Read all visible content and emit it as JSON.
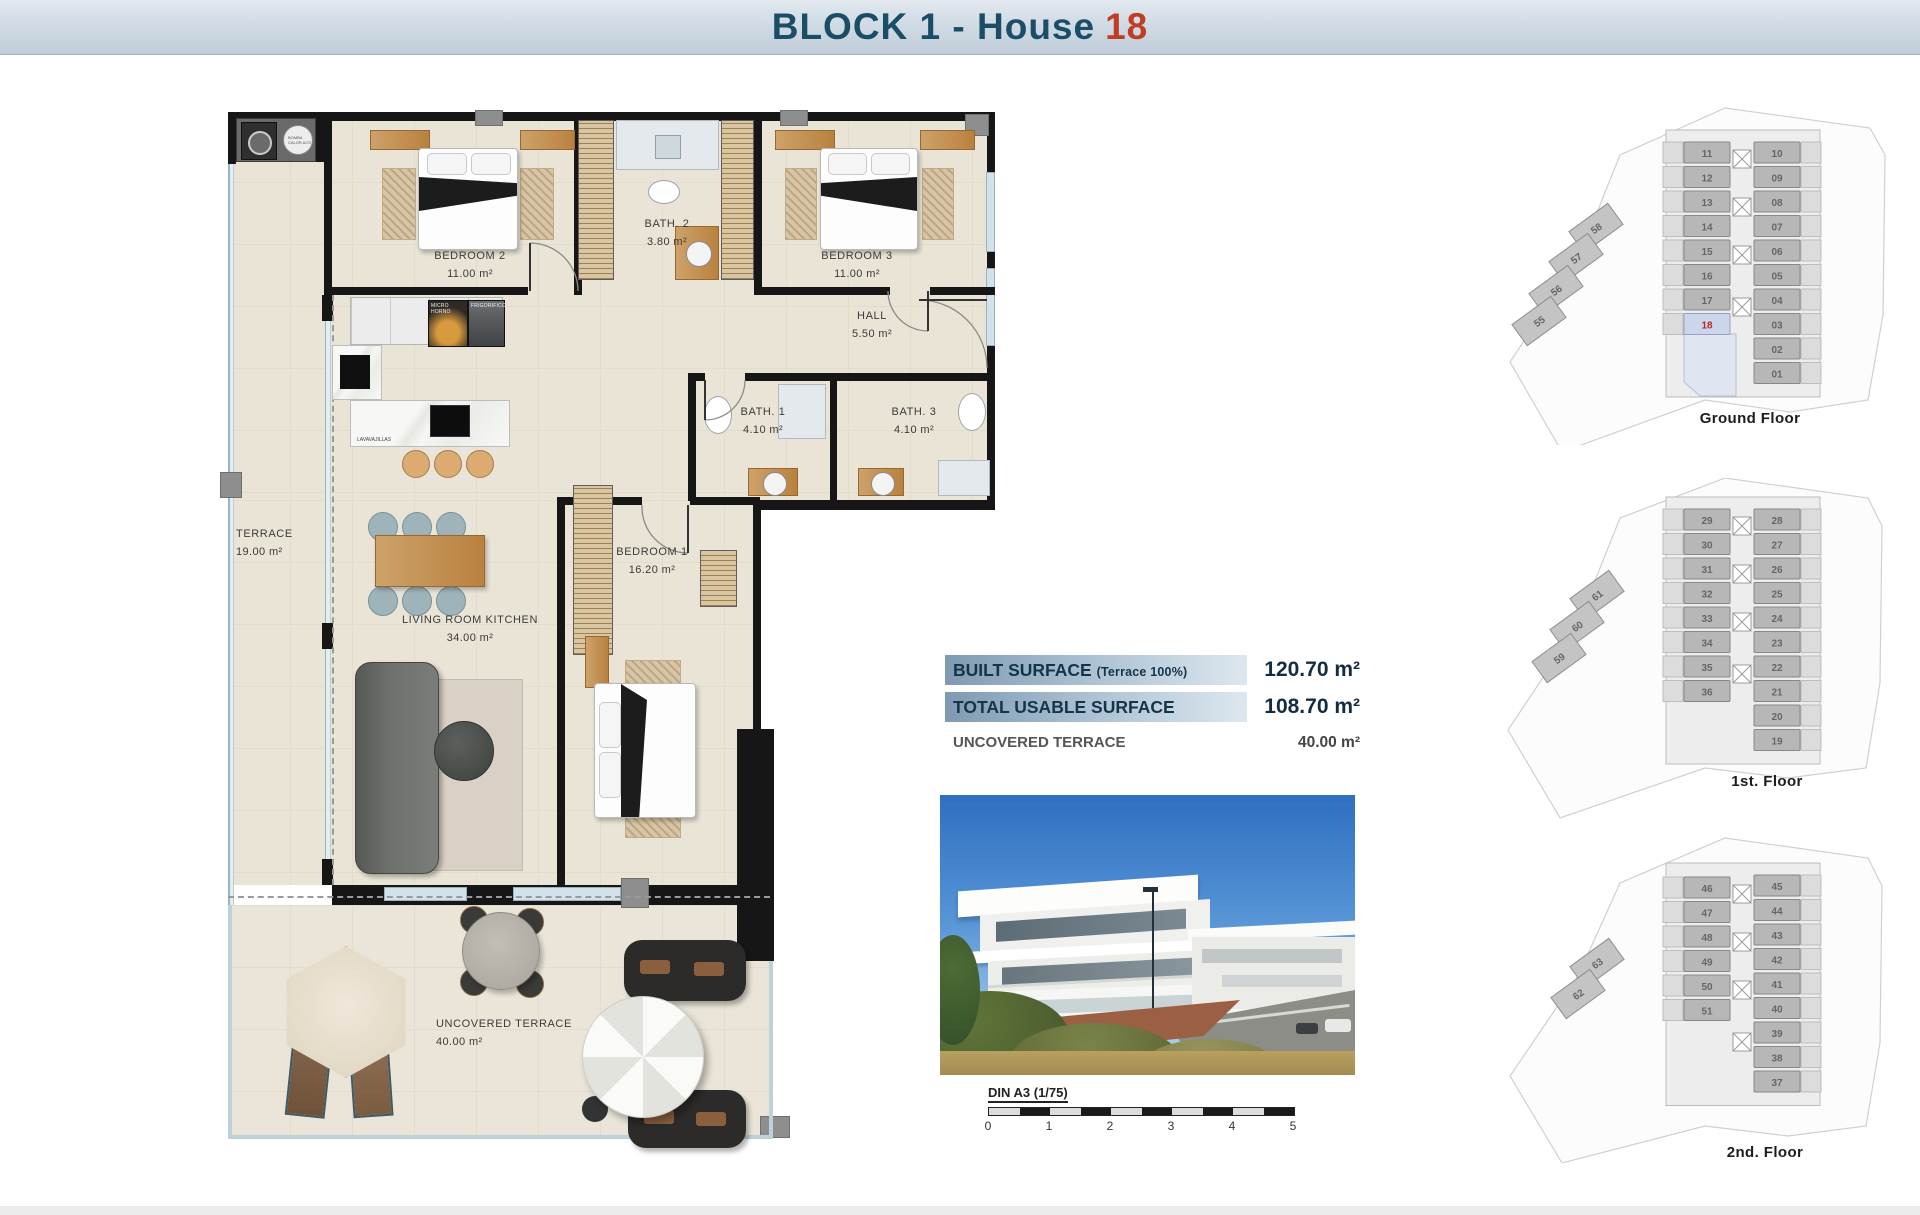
{
  "header": {
    "title": "BLOCK 1 - House",
    "house_number": "18"
  },
  "plan": {
    "rooms": [
      {
        "id": "terrace",
        "name": "TERRACE",
        "area": "19.00 m²"
      },
      {
        "id": "bedroom2",
        "name": "BEDROOM 2",
        "area": "11.00 m²"
      },
      {
        "id": "bath2",
        "name": "BATH. 2",
        "area": "3.80 m²"
      },
      {
        "id": "bedroom3",
        "name": "BEDROOM 3",
        "area": "11.00 m²"
      },
      {
        "id": "hall",
        "name": "HALL",
        "area": "5.50 m²"
      },
      {
        "id": "bath1",
        "name": "BATH. 1",
        "area": "4.10 m²"
      },
      {
        "id": "bath3",
        "name": "BATH. 3",
        "area": "4.10 m²"
      },
      {
        "id": "bedroom1",
        "name": "BEDROOM 1",
        "area": "16.20 m²"
      },
      {
        "id": "living",
        "name": "LIVING ROOM KITCHEN",
        "area": "34.00 m²"
      },
      {
        "id": "uncovered",
        "name": "UNCOVERED TERRACE",
        "area": "40.00 m²"
      }
    ],
    "appliances": {
      "micro": "MICRO HORNO",
      "fridge": "FRIGORIFICO",
      "dishwasher": "LAVAVAJILLAS",
      "washer": "LAVADORA SECADORA",
      "heatpump": "BOMBA CALOR ACS"
    }
  },
  "surface_table": {
    "rows": [
      {
        "label": "BUILT SURFACE",
        "sublabel": "(Terrace 100%)",
        "value": "120.70 m²"
      },
      {
        "label": "TOTAL USABLE SURFACE",
        "sublabel": "",
        "value": "108.70 m²"
      },
      {
        "label": "UNCOVERED TERRACE",
        "sublabel": "",
        "value": "40.00 m²"
      }
    ]
  },
  "scale_bar": {
    "label": "DIN A3 (1/75)",
    "ticks": [
      "0",
      "1",
      "2",
      "3",
      "4",
      "5"
    ]
  },
  "floors": [
    {
      "label": "Ground Floor",
      "highlight": "18",
      "left": [
        "11",
        "12",
        "13",
        "14",
        "15",
        "16",
        "17",
        "18"
      ],
      "right": [
        "10",
        "09",
        "08",
        "07",
        "06",
        "05",
        "04",
        "03",
        "02",
        "01"
      ],
      "annex": [
        "58",
        "57",
        "56",
        "55"
      ]
    },
    {
      "label": "1st. Floor",
      "highlight": "",
      "left": [
        "29",
        "30",
        "31",
        "32",
        "33",
        "34",
        "35",
        "36"
      ],
      "right": [
        "28",
        "27",
        "26",
        "25",
        "24",
        "23",
        "22",
        "21",
        "20",
        "19"
      ],
      "annex": [
        "61",
        "60",
        "59"
      ]
    },
    {
      "label": "2nd. Floor",
      "highlight": "",
      "left": [
        "46",
        "47",
        "48",
        "49",
        "50",
        "51"
      ],
      "right": [
        "45",
        "44",
        "43",
        "42",
        "41",
        "40",
        "39",
        "38",
        "37"
      ],
      "annex": [
        "63",
        "62"
      ]
    }
  ],
  "colors": {
    "title": "#1a4e66",
    "accent_red": "#c13c24",
    "highlight_fill": "#ccd6ea",
    "bar_navy": "#16354d"
  }
}
